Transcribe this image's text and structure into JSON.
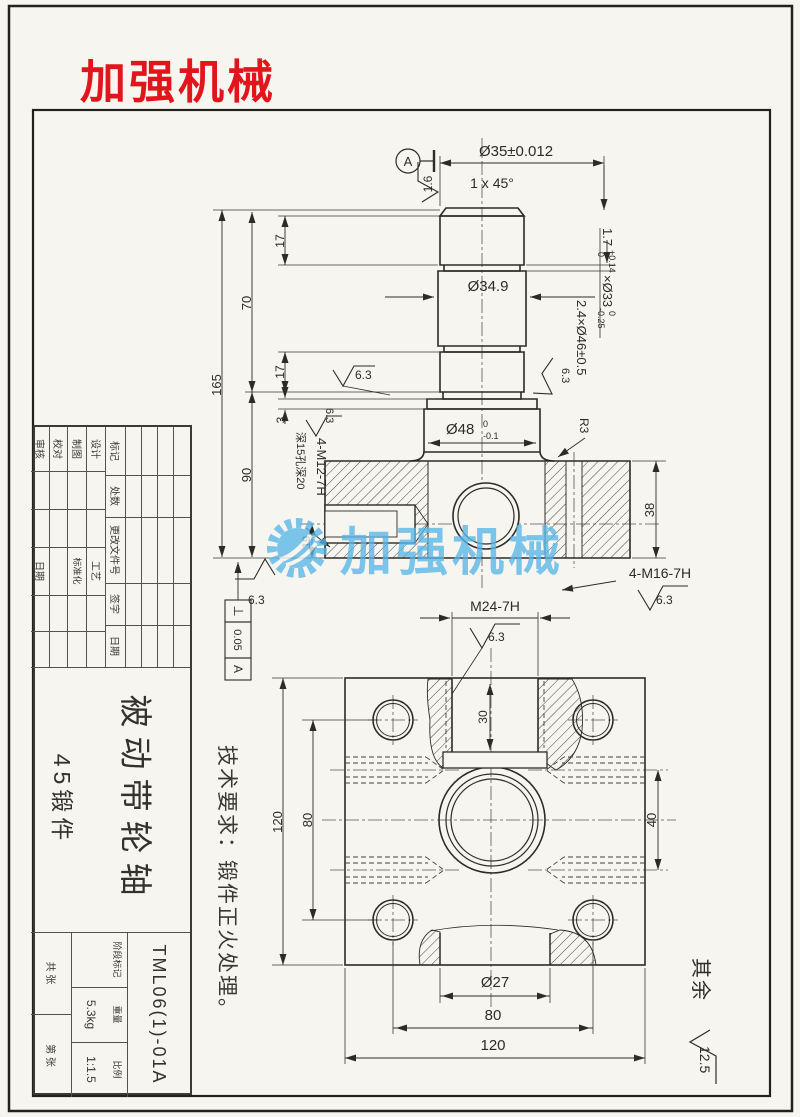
{
  "logo": {
    "text": "加强机械",
    "color": "#e2151d"
  },
  "watermark": {
    "text": "加强机械",
    "color": "#58b5e8"
  },
  "tech_note": "技术要求：锻件正火处理。",
  "shaft_view": {
    "datum_label": "A",
    "finish_1_6": "1.6",
    "finish_6_3": "6.3",
    "dim_d35": "Ø35±0.012",
    "chamfer": "1 x 45°",
    "dim_d349": "Ø34.9",
    "dim_17a": "17",
    "dim_70": "70",
    "dim_165": "165",
    "dim_17b": "17",
    "dim_3": "3",
    "dim_90": "90",
    "dim_19": "19",
    "dim_38": "38",
    "groove1": {
      "v": "1.7",
      "up": "+0.14",
      "dn": "0",
      "x": "×Ø33",
      "up2": "0",
      "dn2": "-0.25"
    },
    "groove2": "2.4×Ø46±0.5",
    "d48": {
      "v": "Ø48",
      "up": "0",
      "dn": "-0.1"
    },
    "r3": "R3",
    "m12": "4-M12-7H",
    "m12_depth": "深15孔深20",
    "m16": "4-M16-7H",
    "tol": {
      "sym": "⊥",
      "val": "0.05",
      "ref": "A"
    }
  },
  "bottom_view": {
    "m24": "M24-7H",
    "finish_6_3": "6.3",
    "dim_30": "30",
    "dim_120_left": "120",
    "dim_80_left": "80",
    "dim_40": "40",
    "dim_d27": "Ø27",
    "dim_80_bottom": "80",
    "dim_120_bottom": "120"
  },
  "corner_note": {
    "qiyu": "其余",
    "val": "12.5"
  },
  "title_block": {
    "rev_headers": [
      "标记",
      "处数",
      "更改文件号",
      "签字",
      "日期"
    ],
    "roles_left": [
      "设计",
      "制图",
      "校对",
      "审核"
    ],
    "roles_right": [
      "工艺",
      "标准化",
      "日期"
    ],
    "part_name": "被动带轮轴",
    "material": "45锻件",
    "drawing_no": "TML06(1)-01A",
    "stage_label": "阶段标记",
    "weight_label": "重量",
    "weight": "5.3kg",
    "scale_label": "比例",
    "scale": "1:1.5",
    "sheet": "共 张",
    "page": "第 张"
  }
}
